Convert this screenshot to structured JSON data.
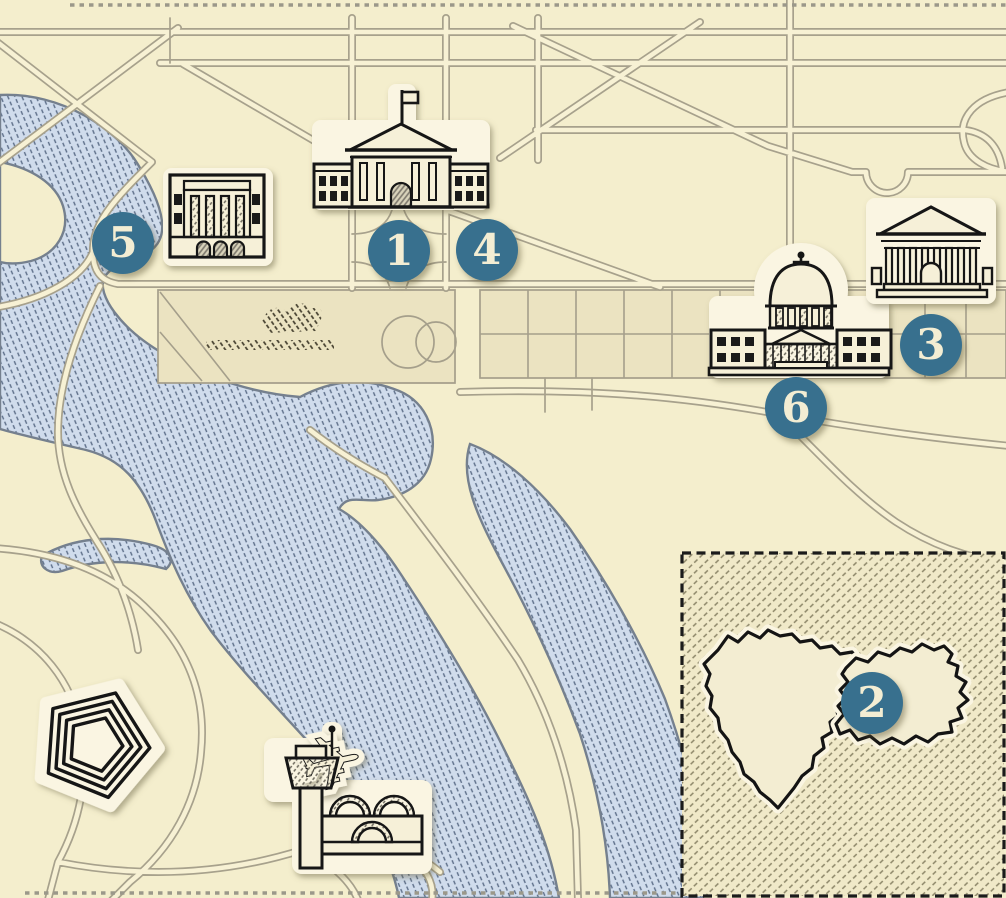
{
  "map": {
    "kind": "illustrated-landmark-map",
    "markers": [
      {
        "label": "1",
        "icon": "white-house",
        "x": 399,
        "y": 251
      },
      {
        "label": "2",
        "icon": "inset-region-outline",
        "x": 872,
        "y": 703
      },
      {
        "label": "3",
        "icon": "classical-temple",
        "x": 931,
        "y": 345
      },
      {
        "label": "4",
        "icon": "white-house-grounds",
        "x": 487,
        "y": 250
      },
      {
        "label": "5",
        "icon": "columned-hall",
        "x": 123,
        "y": 243
      },
      {
        "label": "6",
        "icon": "capitol-building",
        "x": 796,
        "y": 408
      }
    ],
    "landmark_icons": [
      "white-house",
      "capitol-building",
      "classical-temple",
      "columned-hall",
      "pentagon",
      "airport-control-tower",
      "airplane"
    ],
    "features": {
      "water": "hatched river, tidal basin and channel",
      "park": "mall lawn panels with tree scribbles and ellipse",
      "inset": "hatched inset square with jagged region outline",
      "border": "dotted map trim top and bottom"
    },
    "colors": {
      "background": "#f4eecd",
      "park_fill": "#ebe3c1",
      "water_fill": "#d0dcec",
      "water_hatch": "#5e6f89",
      "shoreline": "#75808e",
      "road_casing": "#a7a18c",
      "road_fill": "#f7f1d4",
      "ink": "#161616",
      "plaque": "#faf5e2",
      "marker_fill": "#38708e",
      "marker_text": "#f3edd3",
      "inset_hatch": "#8c8668"
    }
  }
}
